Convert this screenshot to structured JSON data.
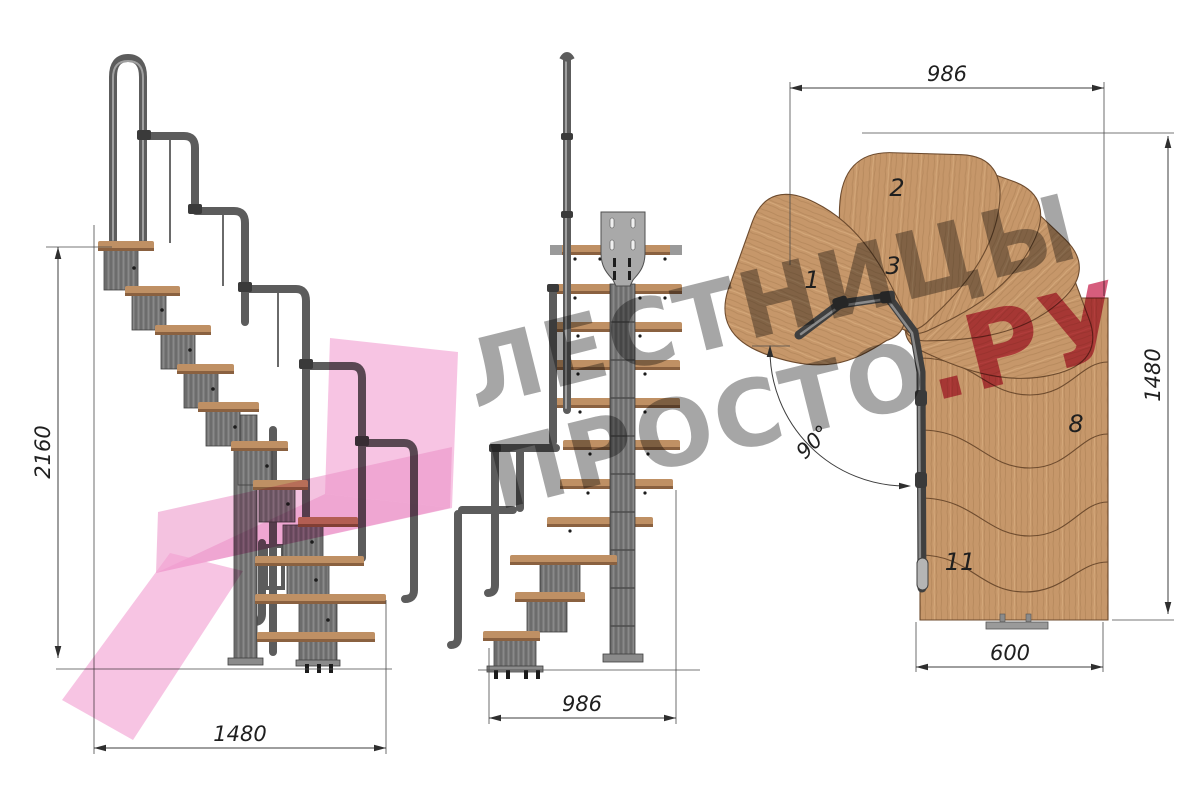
{
  "dimensions": {
    "side_height": "2160",
    "side_run": "1480",
    "front_width": "986",
    "plan_width": "986",
    "plan_depth": "1480",
    "plan_exit_width": "600",
    "turn_angle": "90°"
  },
  "plan_step_numbers": {
    "first": "1",
    "second": "2",
    "third": "3",
    "eighth": "8",
    "eleventh": "11"
  },
  "watermark": {
    "line1": "ЛЕСТНИЦЫ",
    "line2_gray": "ПРОСТО",
    "line2_pink": ".РУ"
  },
  "colors": {
    "wood": "#c6976a",
    "wood_dark": "#8a6140",
    "metal": "#6f6f6f",
    "metal_dark": "#3f3f3f",
    "dimension_line": "#3c3c3c",
    "watermark_gray": "#4d4d4d",
    "watermark_pink": "#cf4166",
    "logo_pink": "#f29fd2"
  }
}
